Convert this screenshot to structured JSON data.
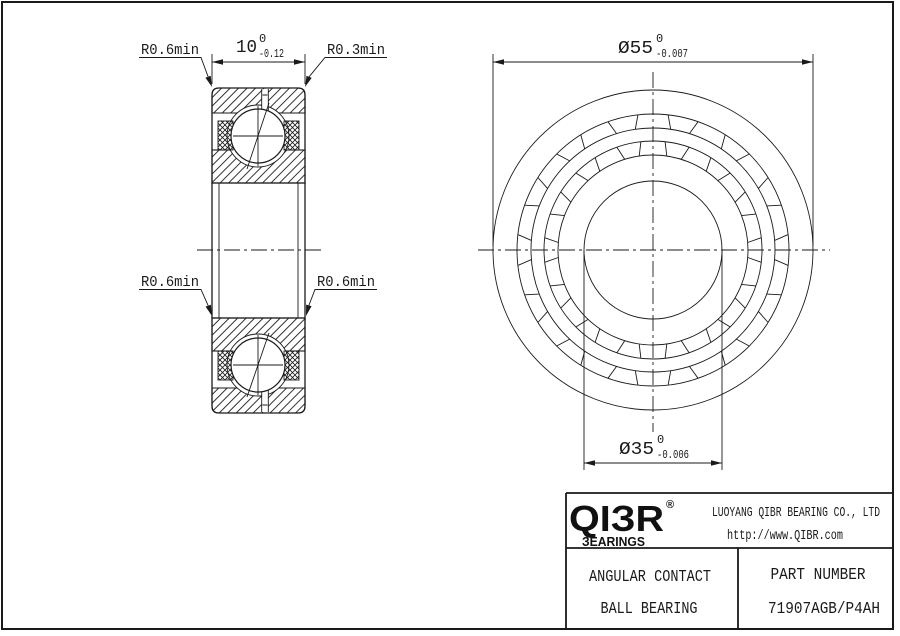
{
  "page": {
    "background": "#ffffff",
    "line_color": "#1a1a1a"
  },
  "section_view": {
    "width_dim": {
      "value": "10",
      "tol_upper": "0",
      "tol_lower": "-0.12"
    },
    "leader_top_left": "R0.6min",
    "leader_top_right": "R0.3min",
    "leader_mid_left": "R0.6min",
    "leader_mid_right": "R0.6min"
  },
  "front_view": {
    "outer_dia": {
      "value": "Ø55",
      "tol_upper": "0",
      "tol_lower": "-0.007"
    },
    "bore_dia": {
      "value": "Ø35",
      "tol_upper": "0",
      "tol_lower": "-0.006"
    }
  },
  "title_block": {
    "logo_text": "QIЗR",
    "logo_registered": "®",
    "logo_subtext": "ЗEARINGS",
    "company": "LUOYANG QIBR BEARING CO., LTD",
    "website": "http://www.QIBR.com",
    "product_type_line1": "ANGULAR CONTACT",
    "product_type_line2": "BALL BEARING",
    "part_number_label": "PART NUMBER",
    "part_number": "71907AGB/P4AH"
  }
}
